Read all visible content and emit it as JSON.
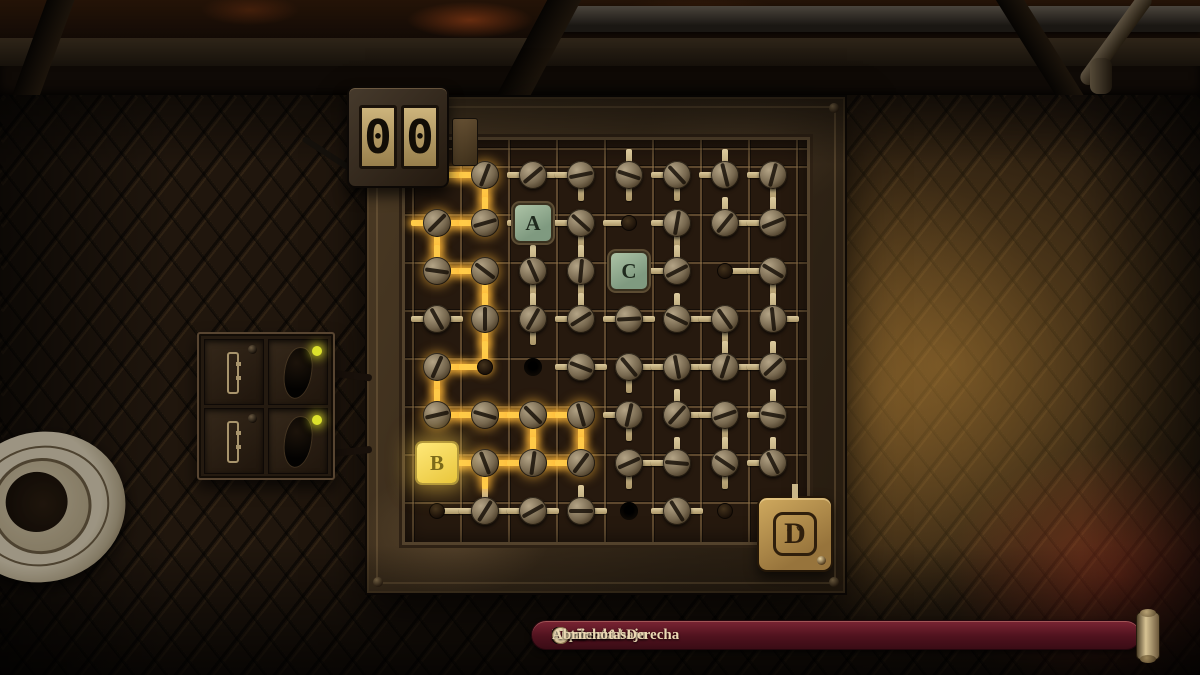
{
  "counter": {
    "digits": [
      "0",
      "0"
    ]
  },
  "selector": {
    "label": "D",
    "arrows": "˄˅"
  },
  "hints": {
    "items": [
      {
        "keys": [
          "S",
          "W"
        ],
        "label": "Arriba / Abajo"
      },
      {
        "keys": [
          "D",
          "A"
        ],
        "label": "Izquierda / Derecha"
      },
      {
        "keys": [
          "Q",
          "E"
        ],
        "label": "Rotar"
      },
      {
        "icon": "mouse-right",
        "label": "Cancelar"
      },
      {
        "keys": [
          "J"
        ],
        "label": "Abrir notas"
      }
    ]
  },
  "colors": {
    "lit_wire": "#ffcd4a",
    "unlit_wire": "#c9b688",
    "tile_green": "#9cb79c",
    "tile_lit": "#f5d94f",
    "brass": "#c9a155",
    "hintbar": "#5a1622",
    "led": "#dde22c"
  },
  "grid": {
    "rows": 8,
    "cols": 8,
    "pitch": 48,
    "cells": [
      {
        "r": 1,
        "c": 1,
        "t": "wire",
        "d": "R",
        "lit": true
      },
      {
        "r": 1,
        "c": 2,
        "t": "screw",
        "d": "LD",
        "lit": true
      },
      {
        "r": 1,
        "c": 3,
        "t": "screw",
        "d": "LR"
      },
      {
        "r": 1,
        "c": 4,
        "t": "screw",
        "d": "LD"
      },
      {
        "r": 1,
        "c": 5,
        "t": "screw",
        "d": "UD"
      },
      {
        "r": 1,
        "c": 6,
        "t": "screw",
        "d": "LD"
      },
      {
        "r": 1,
        "c": 7,
        "t": "screw",
        "d": "UL"
      },
      {
        "r": 1,
        "c": 8,
        "t": "screw",
        "d": "LD"
      },
      {
        "r": 2,
        "c": 1,
        "t": "screw",
        "d": "LRD",
        "lit": true
      },
      {
        "r": 2,
        "c": 2,
        "t": "screw",
        "d": "UL",
        "lit": true
      },
      {
        "r": 2,
        "c": 3,
        "t": "tile",
        "d": "LR",
        "label": "A"
      },
      {
        "r": 2,
        "c": 4,
        "t": "screw",
        "d": "LD"
      },
      {
        "r": 2,
        "c": 5,
        "t": "node",
        "d": "L"
      },
      {
        "r": 2,
        "c": 6,
        "t": "screw",
        "d": "LD"
      },
      {
        "r": 2,
        "c": 7,
        "t": "screw",
        "d": "UR"
      },
      {
        "r": 2,
        "c": 8,
        "t": "screw",
        "d": "UL"
      },
      {
        "r": 3,
        "c": 1,
        "t": "screw",
        "d": "UR",
        "lit": true
      },
      {
        "r": 3,
        "c": 2,
        "t": "screw",
        "d": "LD",
        "lit": true
      },
      {
        "r": 3,
        "c": 3,
        "t": "screw",
        "d": "UD"
      },
      {
        "r": 3,
        "c": 4,
        "t": "screw",
        "d": "UD"
      },
      {
        "r": 3,
        "c": 5,
        "t": "tile",
        "d": "R",
        "label": "C"
      },
      {
        "r": 3,
        "c": 6,
        "t": "screw",
        "d": "UL"
      },
      {
        "r": 3,
        "c": 7,
        "t": "node",
        "d": "R"
      },
      {
        "r": 3,
        "c": 8,
        "t": "screw",
        "d": "LD"
      },
      {
        "r": 4,
        "c": 1,
        "t": "screw",
        "d": "LR"
      },
      {
        "r": 4,
        "c": 2,
        "t": "screw",
        "d": "UD",
        "lit": true
      },
      {
        "r": 4,
        "c": 3,
        "t": "screw",
        "d": "UD"
      },
      {
        "r": 4,
        "c": 4,
        "t": "screw",
        "d": "UL"
      },
      {
        "r": 4,
        "c": 5,
        "t": "screw",
        "d": "LR"
      },
      {
        "r": 4,
        "c": 6,
        "t": "screw",
        "d": "UR"
      },
      {
        "r": 4,
        "c": 7,
        "t": "screw",
        "d": "LD"
      },
      {
        "r": 4,
        "c": 8,
        "t": "screw",
        "d": "UR"
      },
      {
        "r": 5,
        "c": 1,
        "t": "screw",
        "d": "RD",
        "lit": true
      },
      {
        "r": 5,
        "c": 2,
        "t": "node",
        "d": "UL",
        "lit": true
      },
      {
        "r": 5,
        "c": 3,
        "t": "hole",
        "d": ""
      },
      {
        "r": 5,
        "c": 4,
        "t": "screw",
        "d": "LR"
      },
      {
        "r": 5,
        "c": 5,
        "t": "screw",
        "d": "RD"
      },
      {
        "r": 5,
        "c": 6,
        "t": "screw",
        "d": "LR"
      },
      {
        "r": 5,
        "c": 7,
        "t": "screw",
        "d": "ULR"
      },
      {
        "r": 5,
        "c": 8,
        "t": "screw",
        "d": "UL"
      },
      {
        "r": 6,
        "c": 1,
        "t": "screw",
        "d": "UR",
        "lit": true
      },
      {
        "r": 6,
        "c": 2,
        "t": "screw",
        "d": "LR",
        "lit": true
      },
      {
        "r": 6,
        "c": 3,
        "t": "screw",
        "d": "LRD",
        "lit": true
      },
      {
        "r": 6,
        "c": 4,
        "t": "screw",
        "d": "LD",
        "lit": true
      },
      {
        "r": 6,
        "c": 5,
        "t": "screw",
        "d": "LD"
      },
      {
        "r": 6,
        "c": 6,
        "t": "screw",
        "d": "UR"
      },
      {
        "r": 6,
        "c": 7,
        "t": "screw",
        "d": "LD"
      },
      {
        "r": 6,
        "c": 8,
        "t": "screw",
        "d": "UL"
      },
      {
        "r": 7,
        "c": 1,
        "t": "tile",
        "d": "R",
        "lit": true,
        "label": "B"
      },
      {
        "r": 7,
        "c": 2,
        "t": "screw",
        "d": "LRD",
        "lit": true
      },
      {
        "r": 7,
        "c": 3,
        "t": "screw",
        "d": "ULR",
        "lit": true
      },
      {
        "r": 7,
        "c": 4,
        "t": "screw",
        "d": "UL",
        "lit": true
      },
      {
        "r": 7,
        "c": 5,
        "t": "screw",
        "d": "RD"
      },
      {
        "r": 7,
        "c": 6,
        "t": "screw",
        "d": "UL"
      },
      {
        "r": 7,
        "c": 7,
        "t": "screw",
        "d": "UD"
      },
      {
        "r": 7,
        "c": 8,
        "t": "screw",
        "d": "UL"
      },
      {
        "r": 8,
        "c": 1,
        "t": "node",
        "d": "R"
      },
      {
        "r": 8,
        "c": 2,
        "t": "screw",
        "d": "ULR"
      },
      {
        "r": 8,
        "c": 3,
        "t": "screw",
        "d": "LR"
      },
      {
        "r": 8,
        "c": 4,
        "t": "screw",
        "d": "UR"
      },
      {
        "r": 8,
        "c": 5,
        "t": "hole",
        "d": ""
      },
      {
        "r": 8,
        "c": 6,
        "t": "screw",
        "d": "LR"
      },
      {
        "r": 8,
        "c": 7,
        "t": "node",
        "d": ""
      }
    ]
  }
}
